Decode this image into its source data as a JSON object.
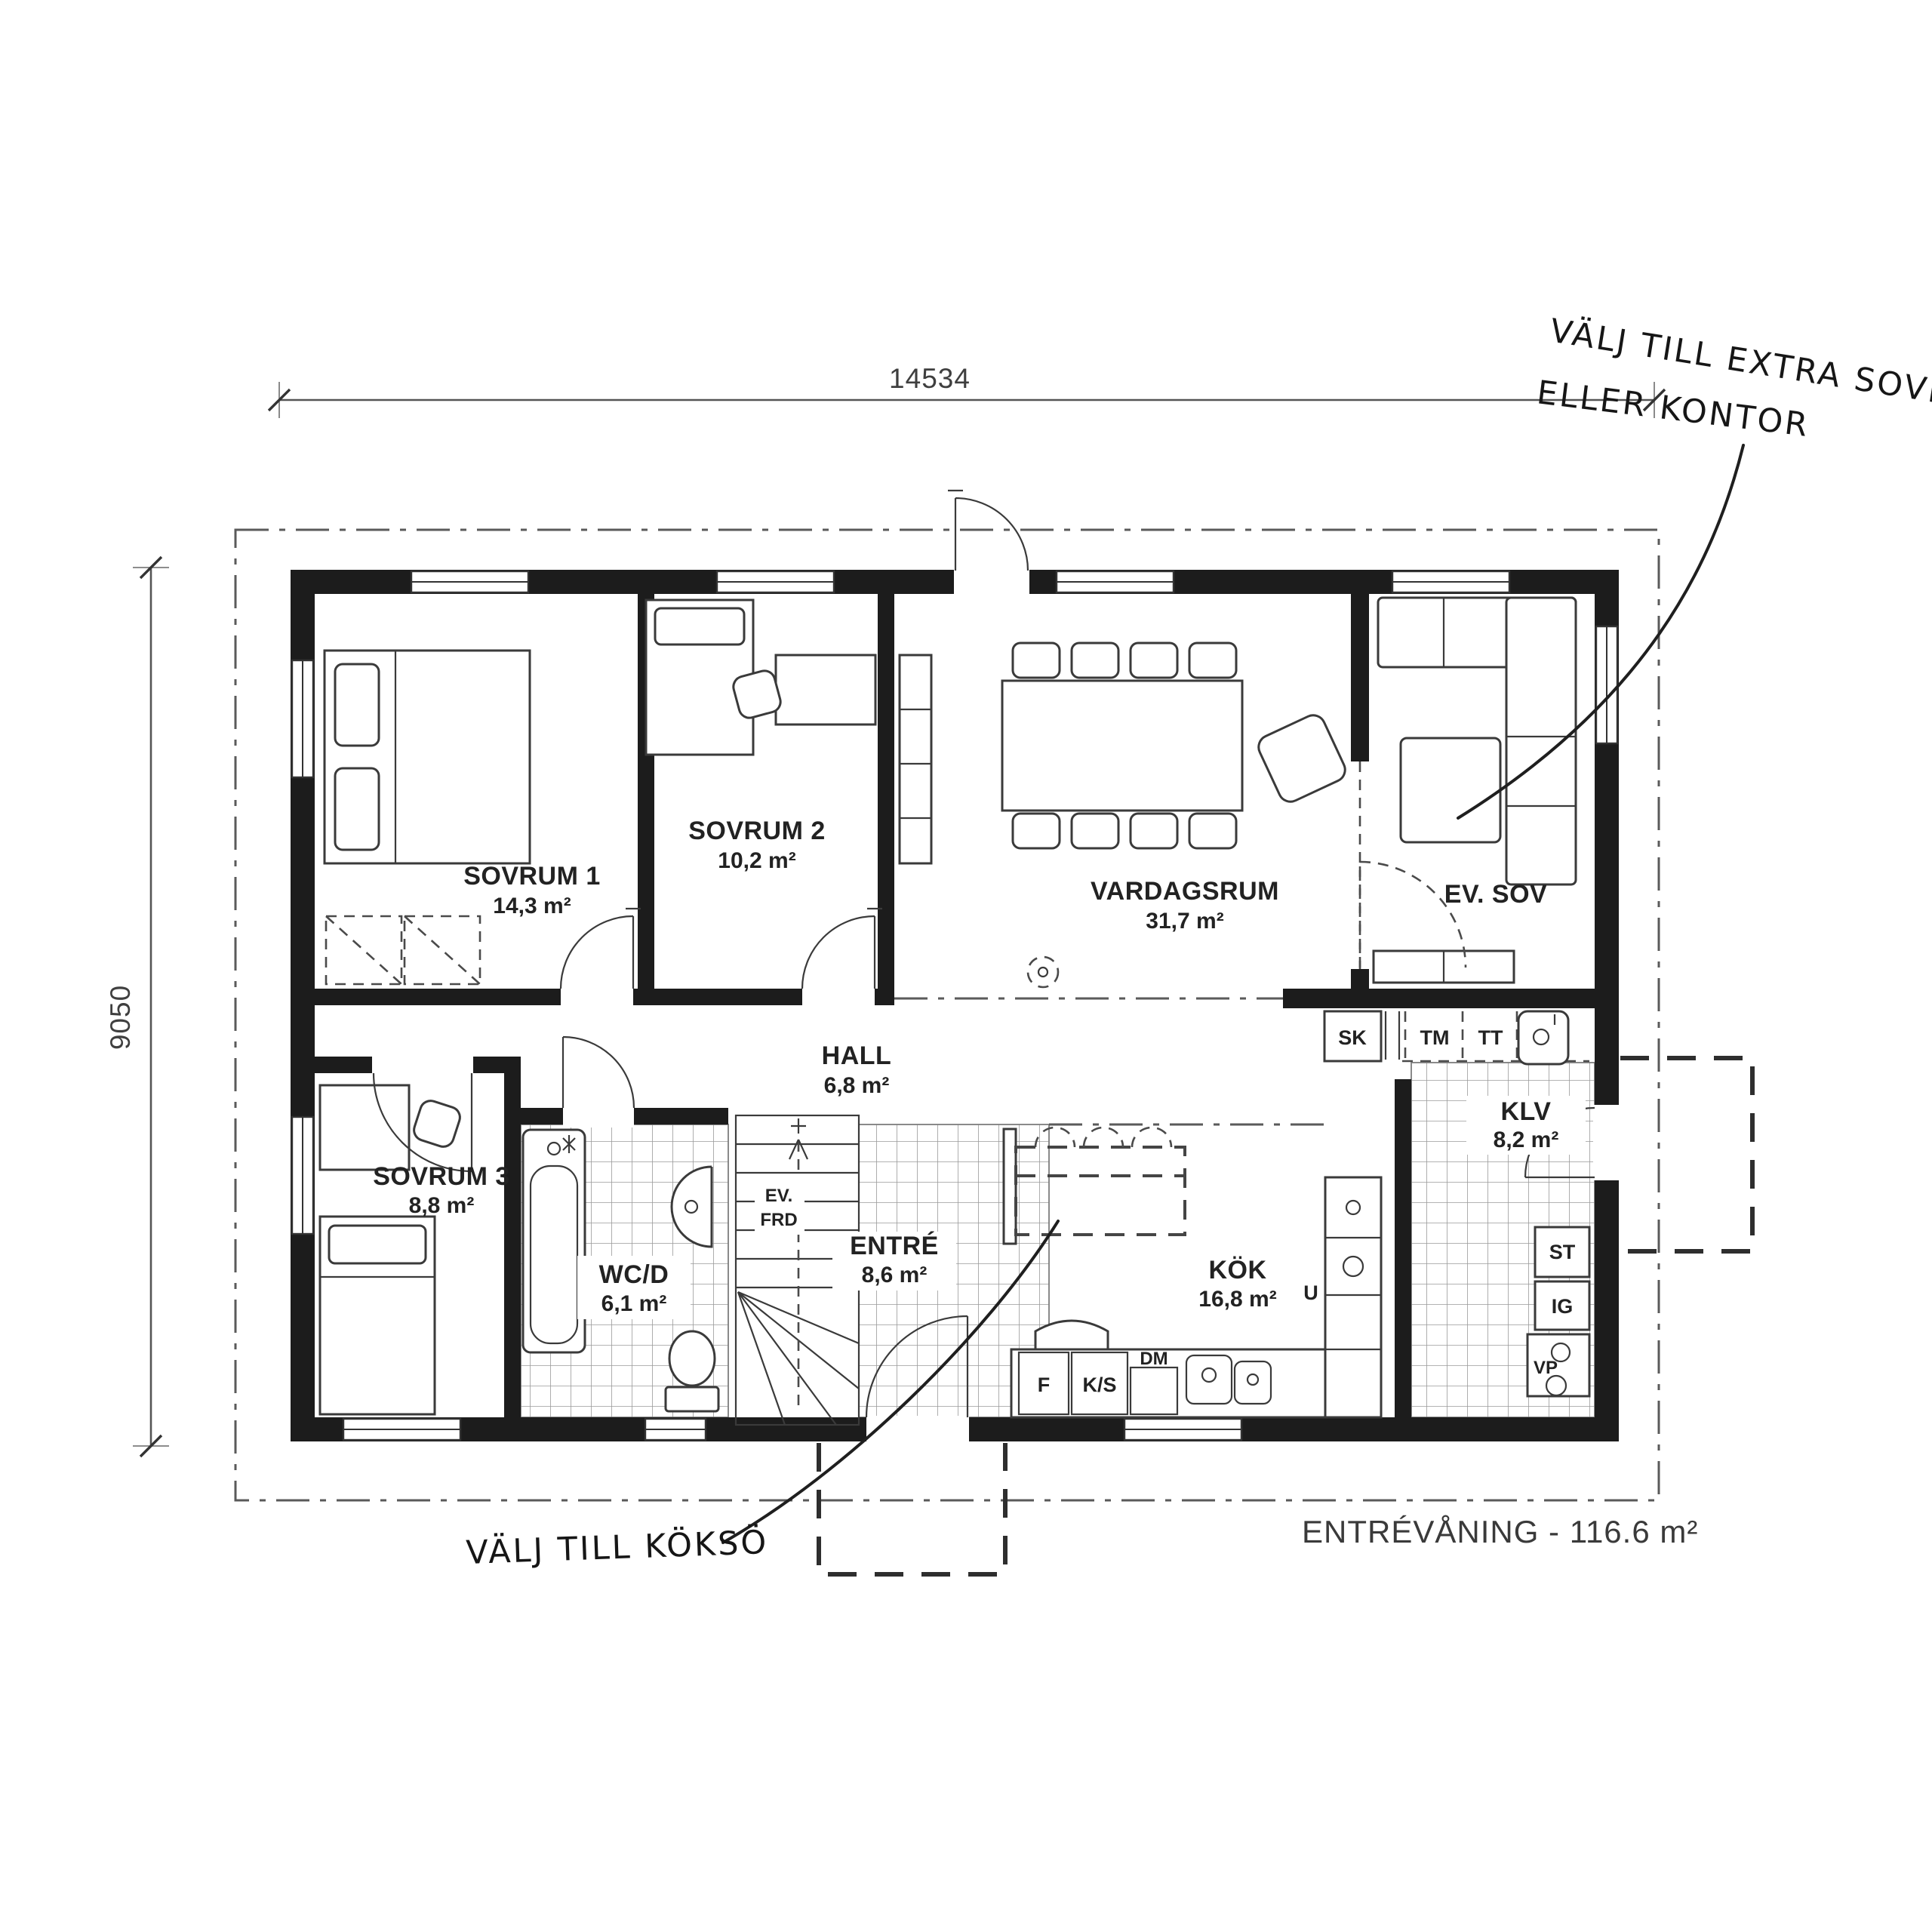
{
  "meta": {
    "floor_label": "ENTRÉVÅNING - 116.6 m²"
  },
  "dimensions": {
    "width": "14534",
    "height": "9050"
  },
  "annotations": {
    "extra_sovrum_line1": "VÄLJ TILL EXTRA SOVRUM",
    "extra_sovrum_line2": "ELLER KONTOR",
    "koksoe": "VÄLJ TILL KÖKSÖ"
  },
  "rooms": {
    "sovrum1": {
      "name": "SOVRUM 1",
      "area": "14,3 m²"
    },
    "sovrum2": {
      "name": "SOVRUM 2",
      "area": "10,2 m²"
    },
    "sovrum3": {
      "name": "SOVRUM 3",
      "area": "8,8 m²"
    },
    "vardagsrum": {
      "name": "VARDAGSRUM",
      "area": "31,7 m²"
    },
    "evsov": {
      "name": "EV. SOV"
    },
    "hall": {
      "name": "HALL",
      "area": "6,8 m²"
    },
    "wcd": {
      "name": "WC/D",
      "area": "6,1 m²"
    },
    "entre": {
      "name": "ENTRÉ",
      "area": "8,6 m²"
    },
    "kok": {
      "name": "KÖK",
      "area": "16,8 m²"
    },
    "klv": {
      "name": "KLV",
      "area": "8,2 m²"
    },
    "evfrd": {
      "line1": "EV.",
      "line2": "FRD"
    }
  },
  "fixtures": {
    "sk": "SK",
    "tm": "TM",
    "tt": "TT",
    "u": "U",
    "f": "F",
    "ks": "K/S",
    "dm": "DM",
    "st": "ST",
    "ig": "IG",
    "vp": "VP"
  },
  "colors": {
    "wall": "#1c1c1c",
    "line": "#3a3a3a",
    "tile": "#9a9a9a"
  }
}
